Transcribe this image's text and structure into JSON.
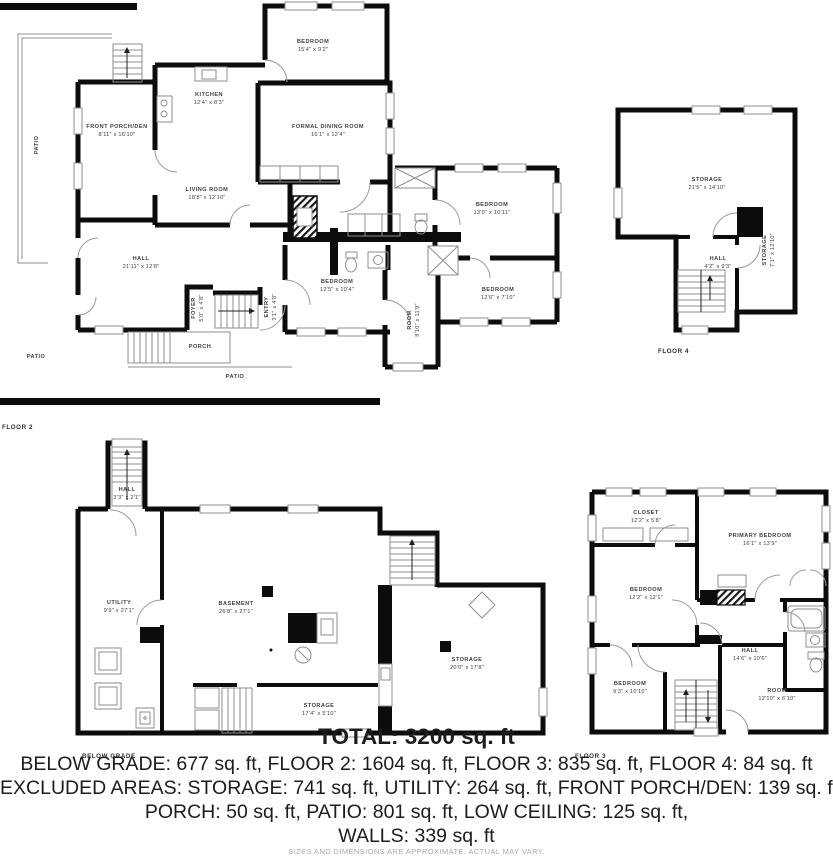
{
  "floor2": {
    "caption": "FLOOR 2",
    "rooms": {
      "bedroom_top": {
        "n": "BEDROOM",
        "d": "15'4\" x 9'2\""
      },
      "kitchen": {
        "n": "KITCHEN",
        "d": "12'4\" x 8'3\""
      },
      "dining": {
        "n": "FORMAL DINING ROOM",
        "d": "16'1\" x 12'4\""
      },
      "porch_den": {
        "n": "FRONT PORCH/DEN",
        "d": "8'11\" x 16'10\""
      },
      "living": {
        "n": "LIVING ROOM",
        "d": "18'8\" x 12'10\""
      },
      "hall": {
        "n": "HALL",
        "d": "21'11\" x 12'8\""
      },
      "bedroom_center": {
        "n": "BEDROOM",
        "d": "12'5\" x 10'4\""
      },
      "bedroom_ne": {
        "n": "BEDROOM",
        "d": "13'9\" x 10'11\""
      },
      "bedroom_se": {
        "n": "BEDROOM",
        "d": "12'6\" x 7'10\""
      },
      "room_s": {
        "n": "ROOM",
        "d": "8'10\" x 11'9\""
      },
      "foyer": {
        "n": "FOYER",
        "d": "5'0\" x 4'8\""
      },
      "entry": {
        "n": "ENTRY",
        "d": "3'1\" x 4'8\""
      },
      "porch": {
        "n": "PORCH"
      },
      "patio_left": {
        "n": "PATIO"
      },
      "patio_bottom1": {
        "n": "PATIO"
      },
      "patio_bottom2": {
        "n": "PATIO"
      }
    }
  },
  "floor4": {
    "caption": "FLOOR 4",
    "rooms": {
      "storage": {
        "n": "STORAGE",
        "d": "21'5\" x 14'10\""
      },
      "hall": {
        "n": "HALL",
        "d": "4'2\" x 9'3\""
      },
      "storage_side": {
        "n": "STORAGE",
        "d": "7'1\" x 12'10\""
      }
    }
  },
  "below_grade": {
    "caption": "BELOW GRADE",
    "rooms": {
      "hall_tower": {
        "n": "HALL",
        "d": "3'3\" x 2'1\""
      },
      "utility": {
        "n": "UTILITY",
        "d": "9'9\" x 27'1\""
      },
      "basement": {
        "n": "BASEMENT",
        "d": "26'8\" x 27'1\""
      },
      "storage_strip": {
        "n": "STORAGE",
        "d": "17'4\" x 5'10\""
      },
      "storage_big": {
        "n": "STORAGE",
        "d": "20'0\" x 17'8\""
      }
    }
  },
  "floor3": {
    "caption": "FLOOR 3",
    "rooms": {
      "closet": {
        "n": "CLOSET",
        "d": "12'2\" x 5'8\""
      },
      "primary": {
        "n": "PRIMARY BEDROOM",
        "d": "16'1\" x 13'9\""
      },
      "bedroom_w": {
        "n": "BEDROOM",
        "d": "12'2\" x 12'1\""
      },
      "hall": {
        "n": "HALL",
        "d": "14'6\" x 10'6\""
      },
      "bedroom_sw": {
        "n": "BEDROOM",
        "d": "9'3\" x 10'10\""
      },
      "room_se": {
        "n": "ROOM",
        "d": "12'10\" x 6'10\""
      }
    }
  },
  "summary": {
    "total": "TOTAL: 3200 sq. ft",
    "line1": "BELOW GRADE: 677 sq. ft, FLOOR 2: 1604 sq. ft, FLOOR 3: 835 sq. ft, FLOOR 4: 84 sq. ft",
    "line2": "EXCLUDED AREAS: STORAGE: 741 sq. ft, UTILITY: 264 sq. ft, FRONT PORCH/DEN: 139 sq. ft",
    "line3": "PORCH: 50 sq. ft, PATIO: 801 sq. ft, LOW CEILING: 125 sq. ft,",
    "line4": "WALLS: 339 sq. ft",
    "disclaimer": "SIZES AND DIMENSIONS ARE APPROXIMATE. ACTUAL MAY VARY."
  },
  "colors": {
    "wall": "#0c0c0c",
    "thin_line": "#8e8e8e",
    "label": "#404040",
    "summary": "#1c1c1c",
    "disclaimer": "#aaaaaa"
  }
}
